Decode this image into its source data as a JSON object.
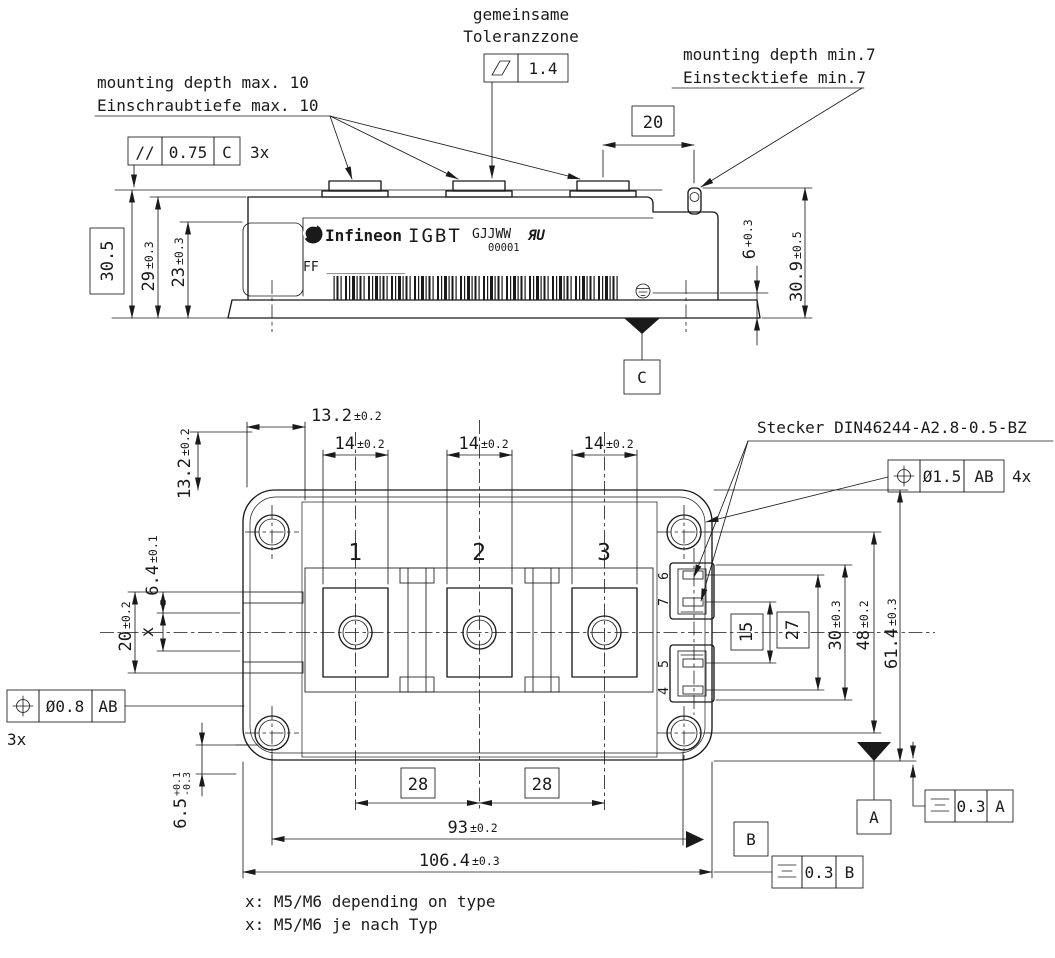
{
  "side_view": {
    "note_common_tolerance": [
      "gemeinsame",
      "Toleranzzone"
    ],
    "flatness": {
      "symbol_icon": "flatness-parallelogram",
      "value": "1.4"
    },
    "note_mount_max": [
      "mounting depth max. 10",
      "Einschraubtiefe max. 10"
    ],
    "note_mount_min": [
      "mounting depth min.7",
      "Einstecktiefe min.7"
    ],
    "parallelism": {
      "symbol": "//",
      "value": "0.75",
      "datum": "C",
      "count": "3x"
    },
    "dims": {
      "overall_height_basic": "30.5",
      "h29": {
        "v": "29",
        "t": "±0.3"
      },
      "h23": {
        "v": "23",
        "t": "±0.3"
      },
      "w20": "20",
      "h6": {
        "v": "6",
        "t": "+0.3"
      },
      "h30_9": {
        "v": "30.9",
        "t": "±0.5"
      }
    },
    "datum_c": "C",
    "label": {
      "brand": "Infineon",
      "product": "IGBT",
      "code": "GJJWW",
      "serial": "00001",
      "ul_mark": "ЯU",
      "line2": "FF __________"
    }
  },
  "top_view": {
    "stecker_note": "Stecker DIN46244-A2.8-0.5-BZ",
    "pos_tol_pins": {
      "symbol_icon": "position-circle-cross",
      "value": "Ø1.5",
      "datum": "AB",
      "count": "4x"
    },
    "pos_tol_terminals": {
      "symbol_icon": "position-circle-cross",
      "value": "Ø0.8",
      "datum": "AB",
      "count": "3x"
    },
    "sym_tol_a": {
      "symbol_icon": "symmetry-three-lines",
      "value": "0.3",
      "datum": "A"
    },
    "sym_tol_b": {
      "symbol_icon": "symmetry-three-lines",
      "value": "0.3",
      "datum": "B"
    },
    "datum_a": "A",
    "datum_b": "B",
    "terminal_labels": [
      "1",
      "2",
      "3"
    ],
    "pin_labels": {
      "p6": "6",
      "p7": "7",
      "p5": "5",
      "p4": "4"
    },
    "dims": {
      "v13_2": {
        "v": "13.2",
        "t": "±0.2"
      },
      "h13_2": {
        "v": "13.2",
        "t": "±0.2"
      },
      "w14_1": {
        "v": "14",
        "t": "±0.2"
      },
      "w14_2": {
        "v": "14",
        "t": "±0.2"
      },
      "w14_3": {
        "v": "14",
        "t": "±0.2"
      },
      "h6_4": {
        "v": "6.4",
        "t": "±0.1"
      },
      "h20": {
        "v": "20",
        "t": "±0.2"
      },
      "hx": "x",
      "p15": "15",
      "p27": "27",
      "h30": {
        "v": "30",
        "t": "±0.3"
      },
      "h48": {
        "v": "48",
        "t": "±0.2"
      },
      "h61_4": {
        "v": "61.4",
        "t": "±0.3"
      },
      "w28_1": "28",
      "w28_2": "28",
      "w93": {
        "v": "93",
        "t": "±0.2"
      },
      "w106_4": {
        "v": "106.4",
        "t": "±0.3"
      },
      "h6_5": {
        "v": "6.5",
        "tp": "+0.1",
        "tm": "-0.3"
      }
    }
  },
  "footnotes": [
    "x: M5/M6 depending on type",
    "x: M5/M6 je nach Typ"
  ]
}
